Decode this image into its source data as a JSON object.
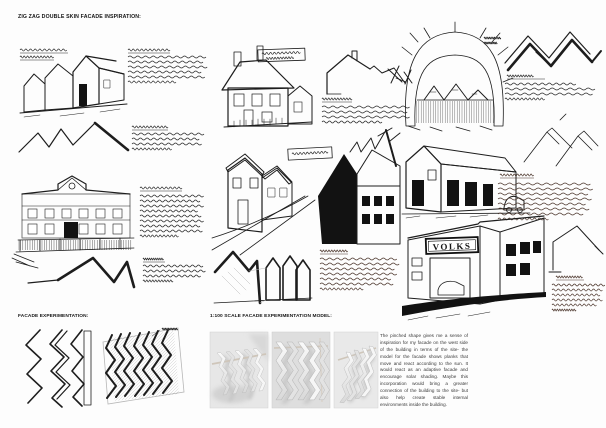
{
  "page": {
    "title": "ZIG ZAG DOUBLE SKIN FACADE INSPIRATION:"
  },
  "sections": {
    "facade_experimentation": {
      "heading": "FACADE EXPERIMENTATION:"
    },
    "scale_model": {
      "heading": "1:100 SCALE FACADE EXPERIMENTATION MODEL:",
      "description": "The pinched shape gives me a sense of inspiration for my facade on the west side of the building in terms of the site- the model for the facade shows planks that move and react according to the sun. It would react as an adaptive facade and encourage solar shading. Maybe this incorporation would bring a greater connection of the building to the site- but also help create stable internal environments inside the building.",
      "photo_count": 3
    }
  },
  "sketches": {
    "volks_sign": "VOLKS",
    "annotation_style": "illegible handwritten ink notes"
  },
  "colors": {
    "ink": "#1d1d1d",
    "sepia_ink": "#4a342a",
    "pencil": "#b7b7b7",
    "paper": "#fdfdfd",
    "photo_background": "#e4e4e4"
  }
}
